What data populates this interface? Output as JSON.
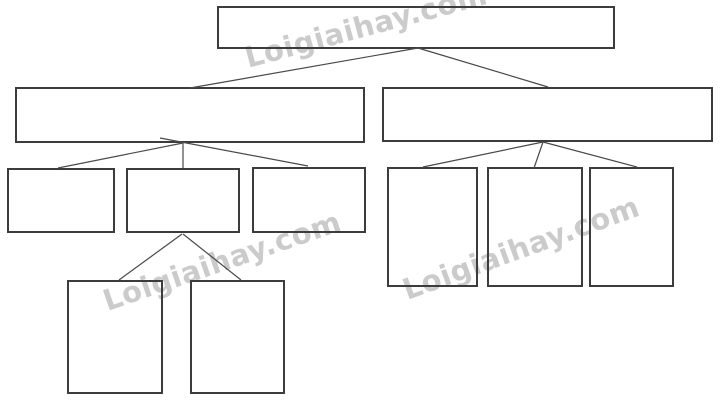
{
  "diagram": {
    "type": "tree",
    "description": "Blank hierarchical tree diagram template with empty boxes",
    "nodes": [
      {
        "id": "root",
        "level": 1,
        "label": ""
      },
      {
        "id": "branch-left",
        "level": 2,
        "label": ""
      },
      {
        "id": "branch-right",
        "level": 2,
        "label": ""
      },
      {
        "id": "left-child-1",
        "level": 3,
        "label": ""
      },
      {
        "id": "left-child-2",
        "level": 3,
        "label": ""
      },
      {
        "id": "left-child-3",
        "level": 3,
        "label": ""
      },
      {
        "id": "right-child-1",
        "level": 3,
        "label": ""
      },
      {
        "id": "right-child-2",
        "level": 3,
        "label": ""
      },
      {
        "id": "right-child-3",
        "level": 3,
        "label": ""
      },
      {
        "id": "grandchild-1",
        "level": 4,
        "label": ""
      },
      {
        "id": "grandchild-2",
        "level": 4,
        "label": ""
      }
    ],
    "edges": [
      [
        "root",
        "branch-left"
      ],
      [
        "root",
        "branch-right"
      ],
      [
        "branch-left",
        "left-child-1"
      ],
      [
        "branch-left",
        "left-child-2"
      ],
      [
        "branch-left",
        "left-child-3"
      ],
      [
        "branch-right",
        "right-child-1"
      ],
      [
        "branch-right",
        "right-child-2"
      ],
      [
        "branch-right",
        "right-child-3"
      ],
      [
        "left-child-2",
        "grandchild-1"
      ],
      [
        "left-child-2",
        "grandchild-2"
      ]
    ]
  },
  "watermark": {
    "text": "Loigiaihay.com",
    "color": "#b9b9b9"
  },
  "colors": {
    "background": "#ffffff",
    "box_border": "#3c3c3c",
    "connector_line": "#4a4a4a"
  }
}
